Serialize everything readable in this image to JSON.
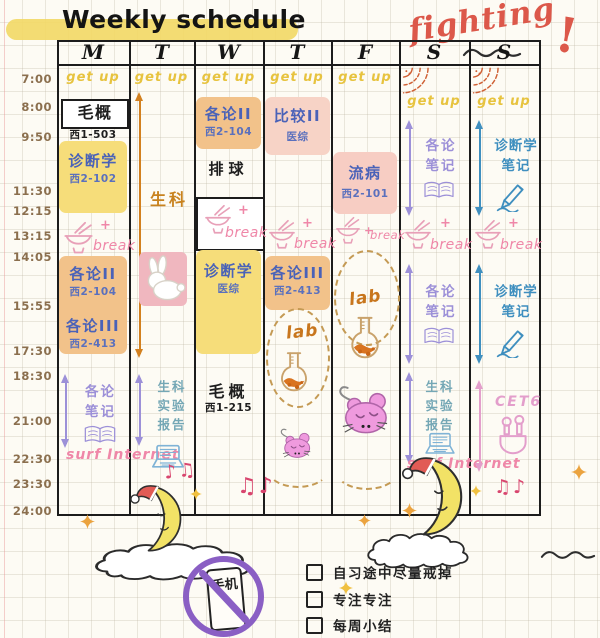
{
  "title": "Weekly schedule",
  "cheer": {
    "word": "fighting",
    "bang": "!"
  },
  "days": [
    "M",
    "T",
    "W",
    "T",
    "F",
    "S",
    "S"
  ],
  "times": [
    "7:00",
    "8:00",
    "9:50",
    "11:30",
    "12:15",
    "13:15",
    "14:05",
    "15:55",
    "17:30",
    "18:30",
    "21:00",
    "22:30",
    "23:30",
    "24:00"
  ],
  "labels": {
    "get_up": "get up",
    "break": "break",
    "plus": "+",
    "surf": "surf Internet",
    "lab": "lab",
    "notes_glyph": "♫♪",
    "notes_glyph2": "♪♫"
  },
  "monday": {
    "c1": "毛概",
    "c1_loc": "西1-503",
    "c2": "诊断学",
    "c2_loc": "西2-102",
    "c3": "各论II",
    "c3_loc": "西2-104",
    "c4": "各论III",
    "c4_loc": "西2-413",
    "night": "各论笔记"
  },
  "tuesday": {
    "day": "生科",
    "night": "生科实验报告"
  },
  "wednesday": {
    "c1": "各论II",
    "c1_loc": "西2-104",
    "sport": "排球",
    "c2": "诊断学",
    "c2_loc": "医综",
    "night": "毛概",
    "night_loc": "西1-215"
  },
  "thursday": {
    "c1": "比较II",
    "c1_loc": "医综",
    "c2": "各论III",
    "c2_loc": "西2-413"
  },
  "friday": {
    "c1": "流病",
    "c1_loc": "西2-101"
  },
  "saturday": {
    "am": "各论笔记",
    "pm": "各论笔记",
    "night": "生科实验报告"
  },
  "sunday": {
    "am": "诊断学笔记",
    "pm": "诊断学笔记",
    "night": "CET6"
  },
  "footer": {
    "phone": "手机",
    "checklist": [
      "自习途中尽量戒掉",
      "专注专注",
      "每周小结"
    ]
  }
}
